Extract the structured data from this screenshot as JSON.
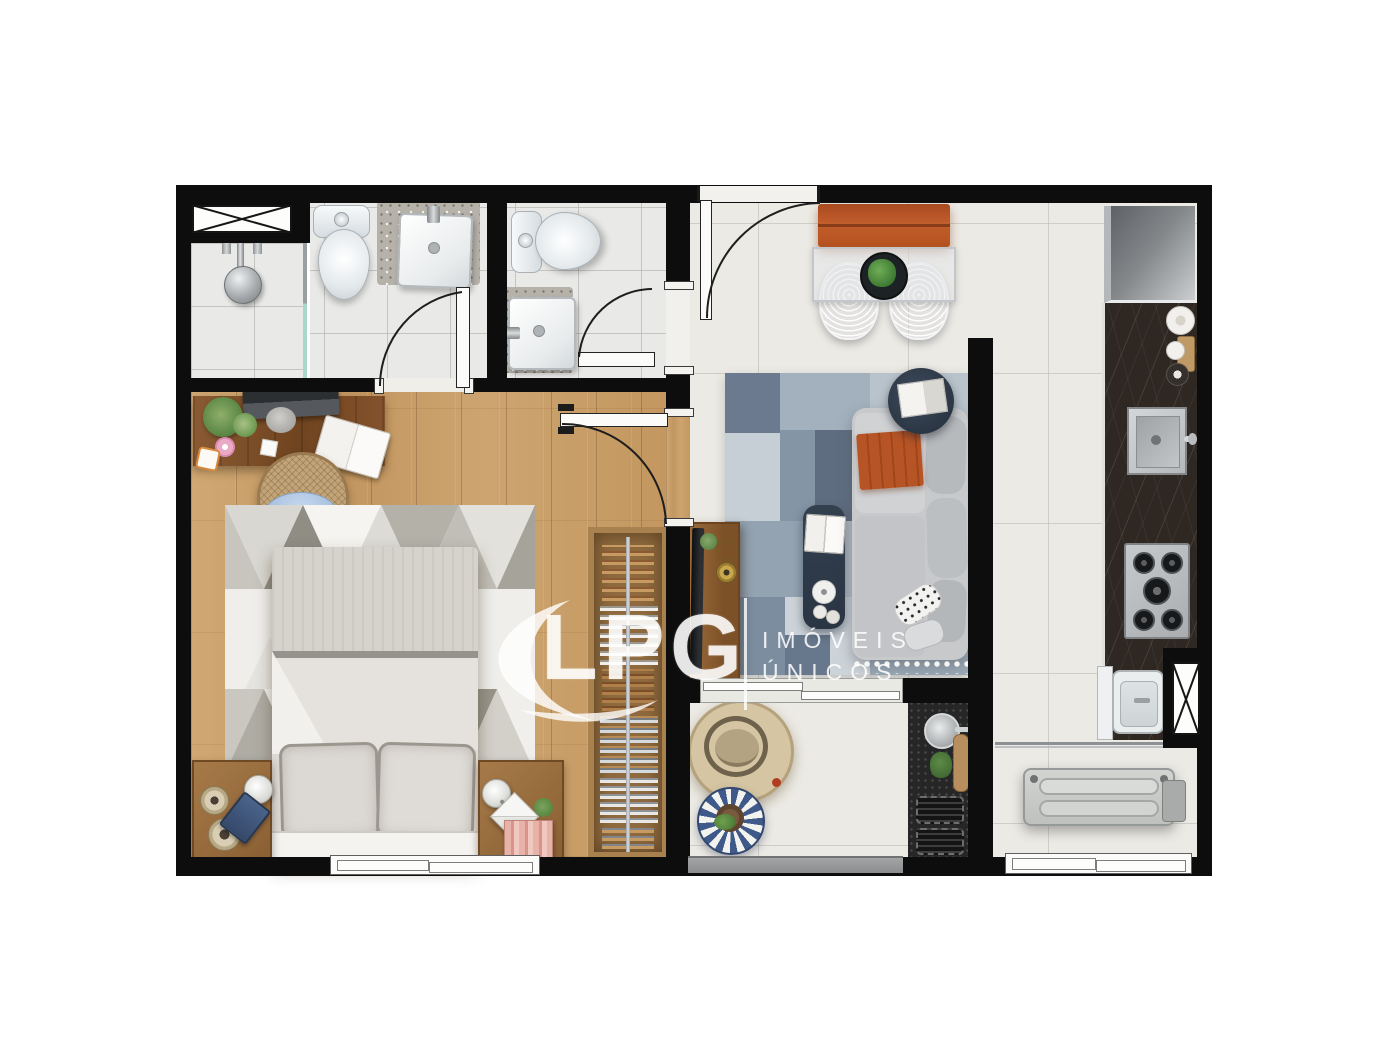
{
  "watermark": {
    "logo_text": "LPG",
    "tagline_line1": "IMÓVEIS",
    "tagline_line2": "ÚNICOS",
    "color": "#ffffff"
  },
  "palette": {
    "background": "#ffffff",
    "wall": "#0d0d0d",
    "wood_floor": "#c89e6a",
    "desk_wood": "#7c4e2a",
    "porcelain_tile": "#eceae4",
    "bath_tile": "#e9e9e7",
    "counter_stone": "#2f2722",
    "accent_orange": "#bf5626",
    "rug_blue_gray": "#93a5b4",
    "bedroom_rug": "#efeeea",
    "sofa_gray": "#c6c8ca",
    "fridge_silver": "#9a9ea1",
    "appliance_steel": "#bdc1c3"
  },
  "elements": {
    "rooms": [
      "suite-bedroom",
      "suite-bathroom",
      "shower-box",
      "social-bathroom",
      "living-dining",
      "kitchen",
      "gourmet-balcony",
      "service-area"
    ],
    "objects": [
      "double-bed",
      "nightstands",
      "triangle-rug",
      "desk",
      "desk-chair",
      "wardrobe",
      "tv-console",
      "sofa",
      "patchwork-rug",
      "coffee-table",
      "side-table",
      "dining-table",
      "dining-bench",
      "wire-chairs",
      "refrigerator",
      "kitchen-sink",
      "cooktop",
      "laundry-tub",
      "washing-machine",
      "grill-counter",
      "hanging-chair",
      "pouf",
      "toilets",
      "washbasins",
      "shower-head",
      "doors",
      "windows",
      "ventilation-shafts"
    ]
  }
}
